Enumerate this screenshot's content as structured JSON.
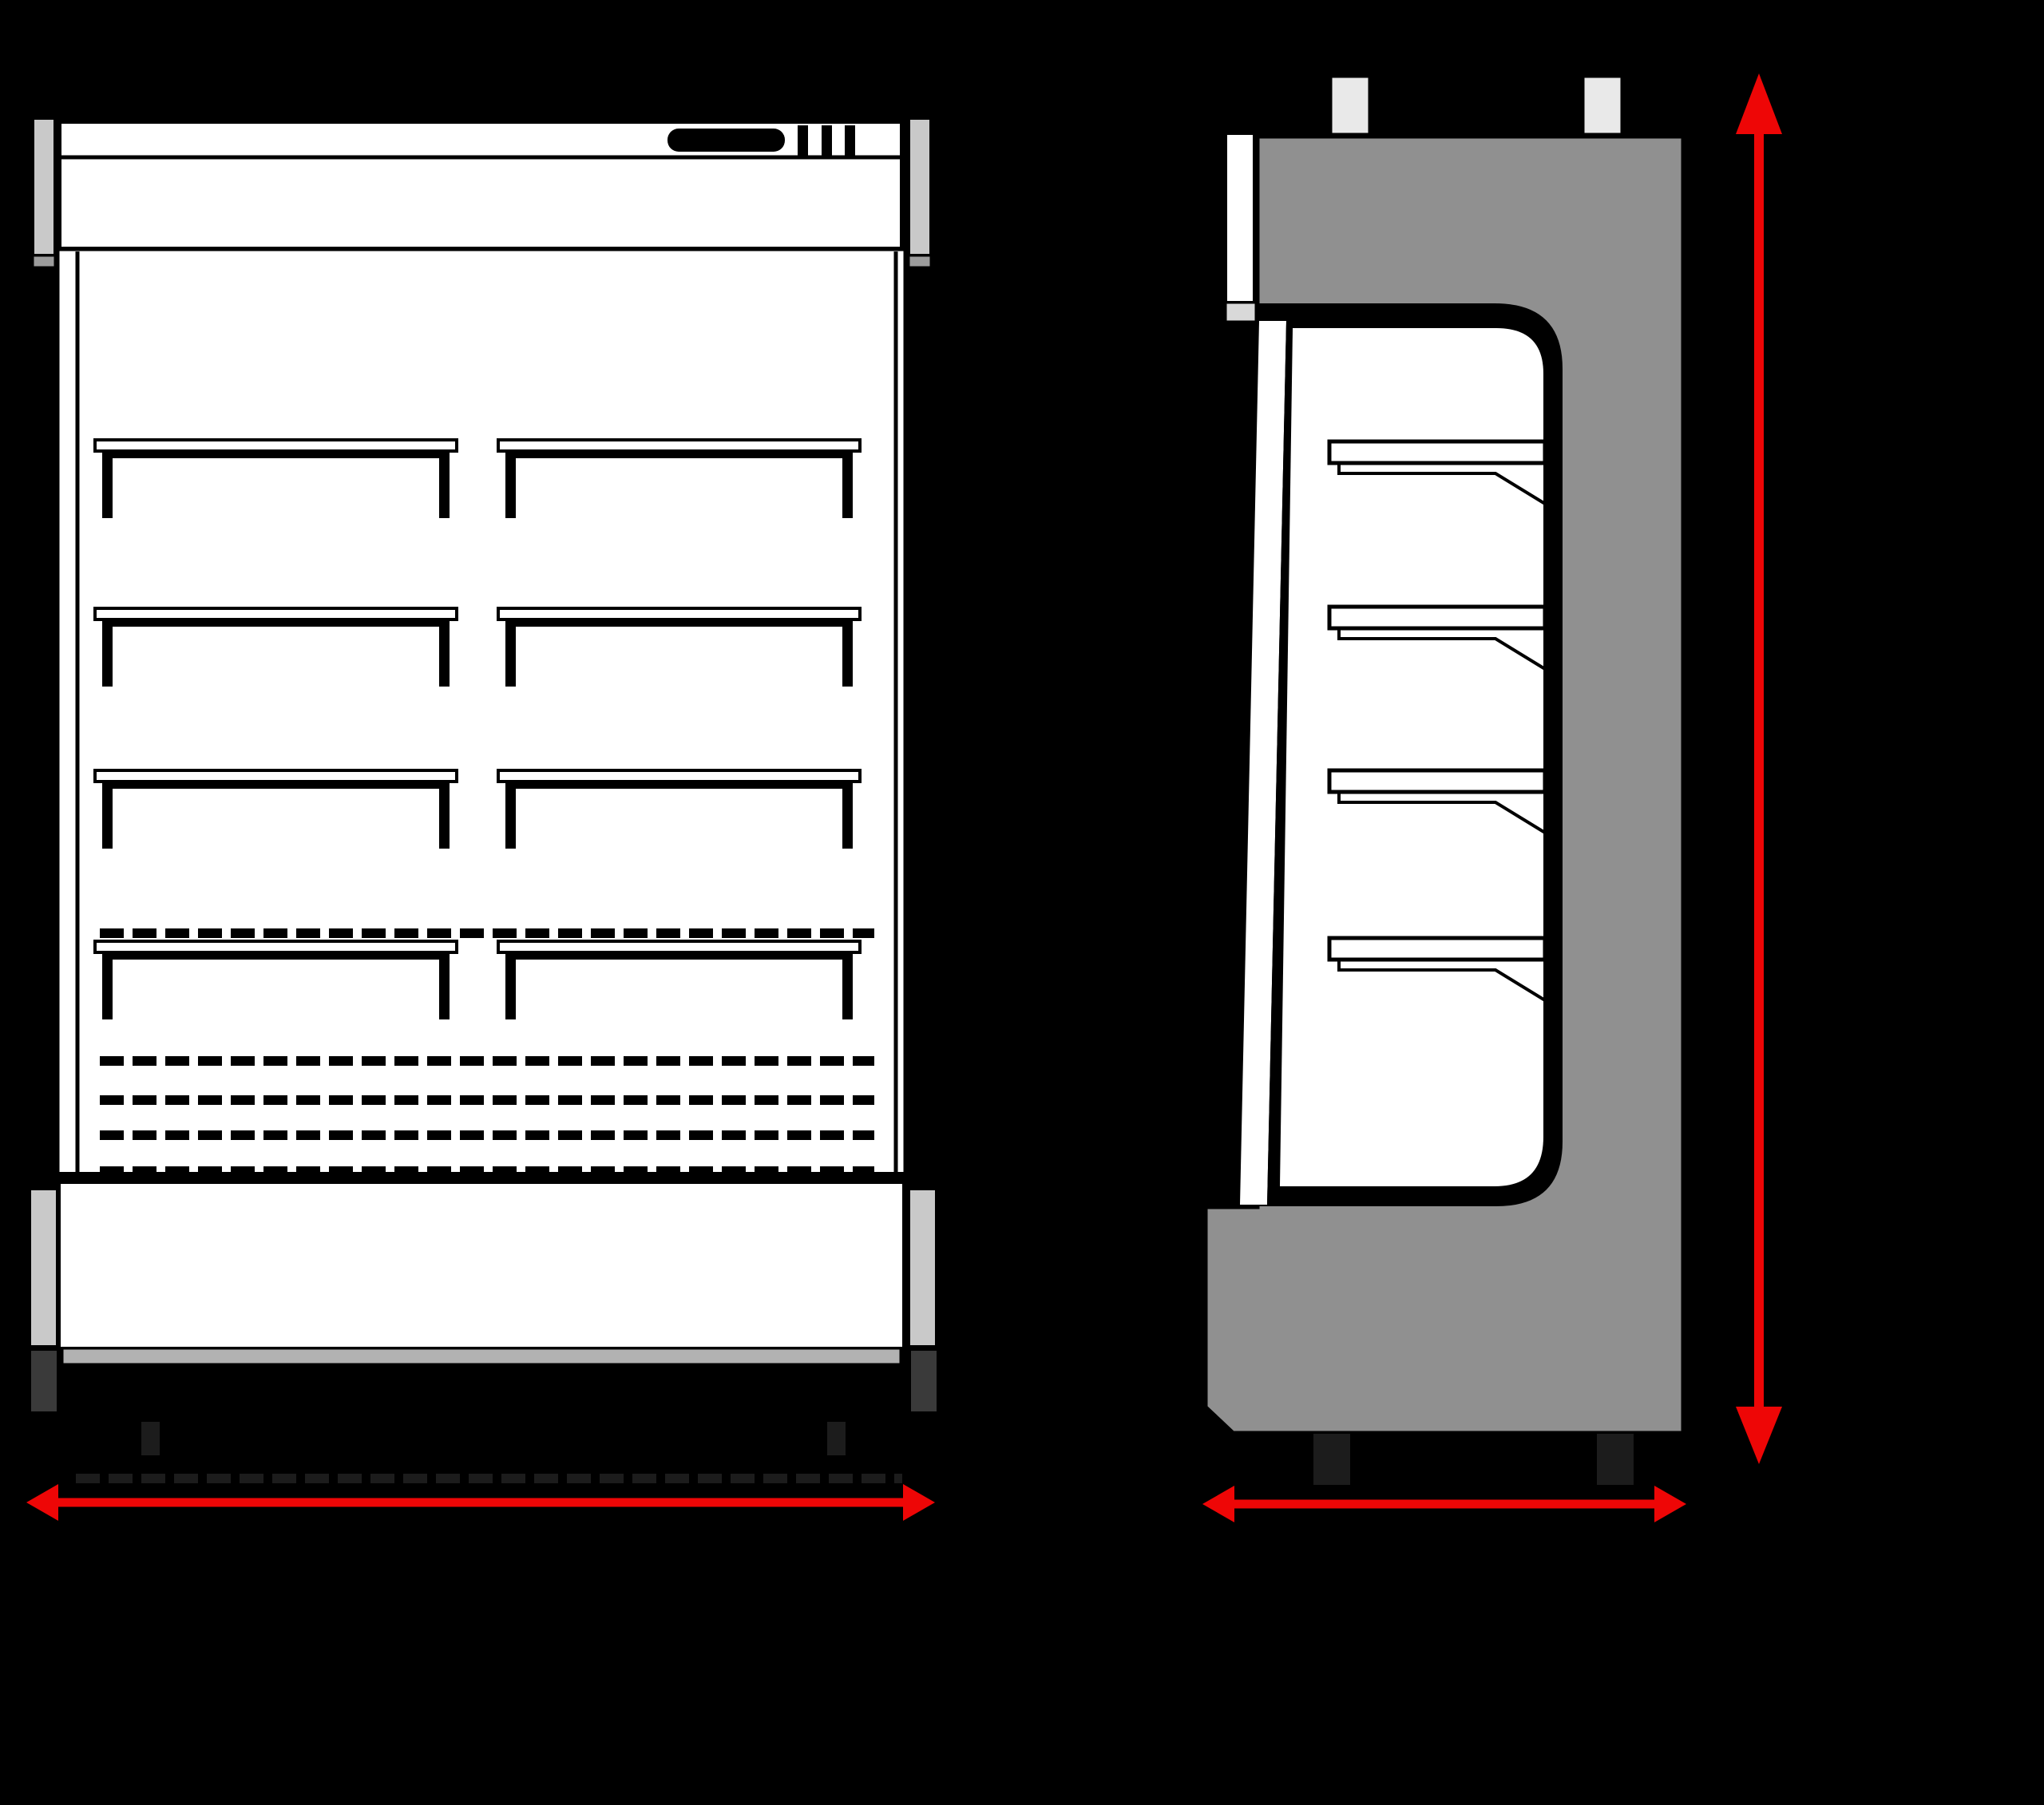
{
  "colors": {
    "background": "#000000",
    "white": "#ffffff",
    "line_black": "#000000",
    "red": "#ee0606",
    "body_gray": "#909090",
    "bracket_light": "#c9c9c9",
    "bracket_mid": "#9c9c9c",
    "strip_gray": "#b2b2b2",
    "strip_light": "#d9d9d9",
    "tab_gray": "#e9e9e9",
    "foot_dark": "#3a3a3a",
    "leg_faint": "#1c1c1c"
  },
  "diagram": {
    "type": "technical-line-drawing",
    "subject": "open-front multideck display cabinet",
    "views": [
      {
        "id": "front-view",
        "shelf_count": 8,
        "shelf_rows": 4,
        "shelf_columns": 2,
        "dashed_vent_rows": 5
      },
      {
        "id": "side-view",
        "shelf_count": 4
      }
    ],
    "dimension_arrows": [
      {
        "id": "front-width-arrow",
        "orientation": "horizontal",
        "style": "double-headed"
      },
      {
        "id": "side-depth-arrow",
        "orientation": "horizontal",
        "style": "double-headed"
      },
      {
        "id": "height-arrow",
        "orientation": "vertical",
        "style": "double-headed"
      }
    ]
  }
}
